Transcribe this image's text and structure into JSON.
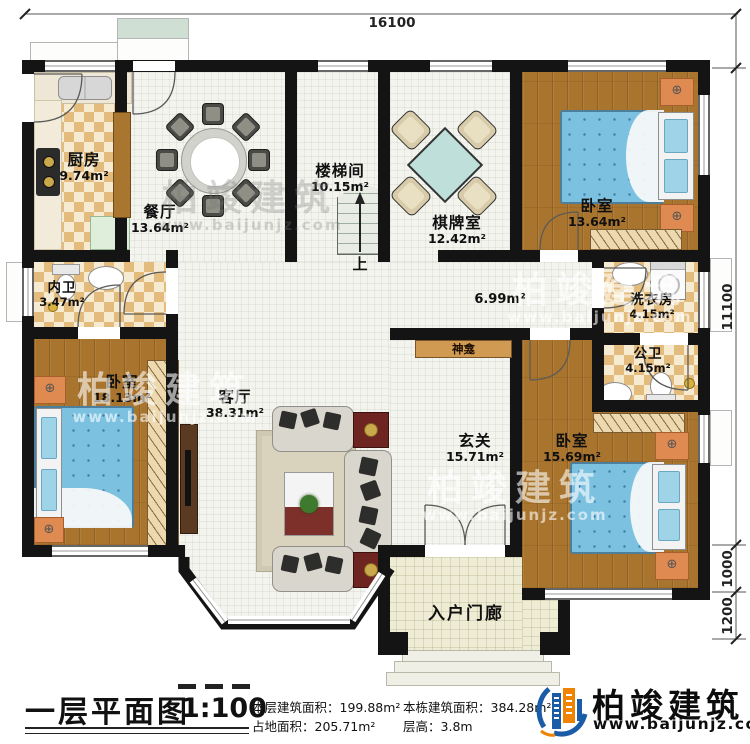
{
  "dimensions": {
    "top": "16100",
    "right_main": "11100",
    "right_bay": "1000",
    "right_porch": "1200"
  },
  "rooms": {
    "kitchen": {
      "name": "厨房",
      "area": "9.74m²"
    },
    "dining": {
      "name": "餐厅",
      "area": "13.64m²"
    },
    "stair_hall": {
      "name": "楼梯间",
      "area": "10.15m²"
    },
    "stairs_up_label": "上",
    "chess_room": {
      "name": "棋牌室",
      "area": "12.42m²"
    },
    "bedroom_top_right": {
      "name": "卧室",
      "area": "13.64m²"
    },
    "ensuite_bath": {
      "name": "内卫",
      "area": "3.47m²"
    },
    "laundry": {
      "name": "洗衣房",
      "area": "4.15m²"
    },
    "public_bath": {
      "name": "公卫",
      "area": "4.15m²"
    },
    "bedroom_left": {
      "name": "卧室",
      "area": "18.13m²"
    },
    "living": {
      "name": "客厅",
      "area": "38.31m²"
    },
    "foyer": {
      "name": "玄关",
      "area": "15.71m²"
    },
    "bedroom_bottom_right": {
      "name": "卧室",
      "area": "15.69m²"
    },
    "hallway": {
      "area": "6.99m²"
    },
    "shrine": {
      "name": "神龛"
    },
    "porch": {
      "name": "入户门廊"
    }
  },
  "footer": {
    "plan_title": "一层平面图",
    "scale": "1:100",
    "stats": [
      {
        "label": "本层建筑面积：",
        "value": "199.88m²"
      },
      {
        "label": "占地面积：",
        "value": "205.71m²"
      },
      {
        "label": "本栋建筑面积：",
        "value": "384.28m²"
      },
      {
        "label": "层高：",
        "value": "3.8m"
      }
    ],
    "brand": {
      "name": "柏竣建筑",
      "website": "www.baijunjz.com"
    }
  },
  "watermark": {
    "name": "柏竣建筑",
    "website": "www.baijunjz.com"
  }
}
